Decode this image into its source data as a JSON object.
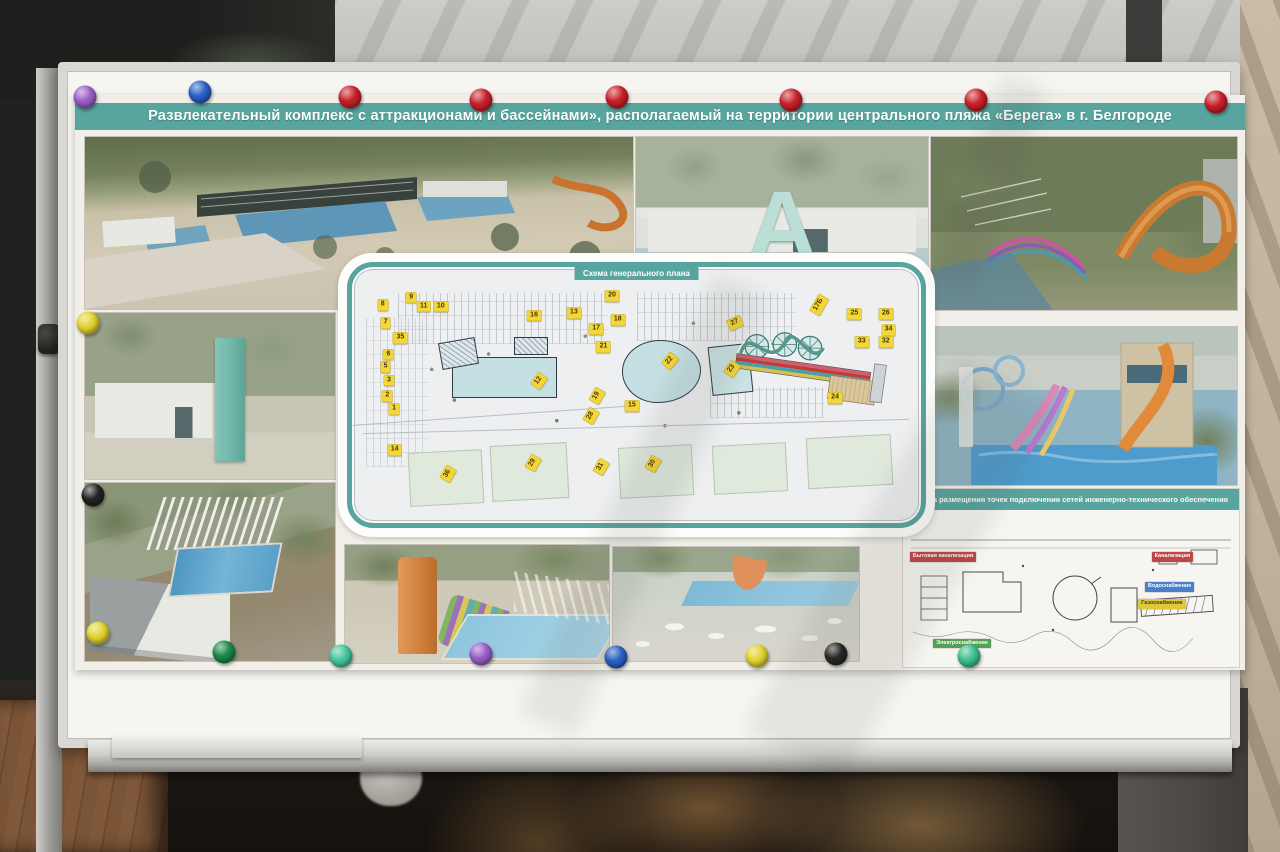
{
  "poster": {
    "title": "Развлекательный комплекс с аттракционами и бассейнами», располагаемый на территории центрального пляжа «Берега» в г. Белгороде",
    "entrance_letter": "A",
    "general_plan": {
      "title": "Схема генерального плана",
      "markers": [
        {
          "n": "8",
          "x": 5.4,
          "y": 14.8
        },
        {
          "n": "9",
          "x": 10.4,
          "y": 12.0
        },
        {
          "n": "11",
          "x": 12.6,
          "y": 15.5
        },
        {
          "n": "10",
          "x": 15.6,
          "y": 15.5
        },
        {
          "n": "7",
          "x": 5.9,
          "y": 21.8
        },
        {
          "n": "35",
          "x": 8.5,
          "y": 27.8
        },
        {
          "n": "6",
          "x": 6.4,
          "y": 34.2
        },
        {
          "n": "5",
          "x": 5.9,
          "y": 39.1
        },
        {
          "n": "3",
          "x": 6.5,
          "y": 44.4
        },
        {
          "n": "2",
          "x": 6.2,
          "y": 50.4
        },
        {
          "n": "1",
          "x": 7.4,
          "y": 55.6
        },
        {
          "n": "14",
          "x": 7.5,
          "y": 71.5
        },
        {
          "n": "16",
          "x": 32.0,
          "y": 19.0
        },
        {
          "n": "13",
          "x": 39.0,
          "y": 18.0
        },
        {
          "n": "17",
          "x": 42.9,
          "y": 24.3
        },
        {
          "n": "18",
          "x": 46.7,
          "y": 20.8
        },
        {
          "n": "20",
          "x": 45.7,
          "y": 11.3
        },
        {
          "n": "21",
          "x": 44.2,
          "y": 31.3
        },
        {
          "n": "12",
          "x": 32.8,
          "y": 44.7,
          "r": -55
        },
        {
          "n": "19",
          "x": 43.0,
          "y": 50.3,
          "r": -60
        },
        {
          "n": "28",
          "x": 42.0,
          "y": 58.1,
          "r": -60
        },
        {
          "n": "15",
          "x": 49.2,
          "y": 54.2
        },
        {
          "n": "22",
          "x": 55.9,
          "y": 36.6,
          "r": -50
        },
        {
          "n": "27",
          "x": 67.3,
          "y": 21.8,
          "r": -25
        },
        {
          "n": "23",
          "x": 66.7,
          "y": 39.8,
          "r": -55
        },
        {
          "n": "24",
          "x": 84.9,
          "y": 51.1
        },
        {
          "n": "25",
          "x": 88.3,
          "y": 18.3
        },
        {
          "n": "26",
          "x": 93.8,
          "y": 18.3
        },
        {
          "n": "34",
          "x": 94.3,
          "y": 24.6
        },
        {
          "n": "33",
          "x": 89.6,
          "y": 29.2
        },
        {
          "n": "32",
          "x": 93.8,
          "y": 29.2
        },
        {
          "n": "17Б",
          "x": 82.1,
          "y": 14.8,
          "r": -60
        },
        {
          "n": "36",
          "x": 16.8,
          "y": 81.0,
          "r": -60
        },
        {
          "n": "29",
          "x": 31.8,
          "y": 76.4,
          "r": -60
        },
        {
          "n": "31",
          "x": 43.7,
          "y": 78.2,
          "r": -60
        },
        {
          "n": "30",
          "x": 52.9,
          "y": 77.1,
          "r": -60
        }
      ]
    },
    "engineering_scheme": {
      "title": "Схема размещения точек подключения сетей инженерно-технического обеспечения",
      "legend": [
        {
          "label": "Бытовая канализация",
          "color": "#c04545",
          "text": "#ffffff",
          "x": 2,
          "y": 27
        },
        {
          "label": "Электроснабжение",
          "color": "#55a055",
          "text": "#ffffff",
          "x": 9,
          "y": 82
        },
        {
          "label": "Канализация",
          "color": "#c04545",
          "text": "#ffffff",
          "x": 74,
          "y": 27
        },
        {
          "label": "Водоснабжение",
          "color": "#4a7ec8",
          "text": "#ffffff",
          "x": 72,
          "y": 46
        },
        {
          "label": "Газоснабжение",
          "color": "#ddc83e",
          "text": "#4a3c00",
          "x": 70,
          "y": 57
        }
      ]
    }
  },
  "magnets": [
    {
      "color": "#9a5fc9",
      "x": 85,
      "y": 97
    },
    {
      "color": "#2a60c8",
      "x": 200,
      "y": 92
    },
    {
      "color": "#c9202a",
      "x": 350,
      "y": 97
    },
    {
      "color": "#c9202a",
      "x": 481,
      "y": 100
    },
    {
      "color": "#c9202a",
      "x": 617,
      "y": 97
    },
    {
      "color": "#c9202a",
      "x": 791,
      "y": 100
    },
    {
      "color": "#c9202a",
      "x": 976,
      "y": 100
    },
    {
      "color": "#c9202a",
      "x": 1216,
      "y": 102
    },
    {
      "color": "#e3d32f",
      "x": 88,
      "y": 323
    },
    {
      "color": "#242424",
      "x": 93,
      "y": 495
    },
    {
      "color": "#e3d32f",
      "x": 98,
      "y": 633
    },
    {
      "color": "#188a4b",
      "x": 224,
      "y": 652
    },
    {
      "color": "#45c79d",
      "x": 341,
      "y": 656
    },
    {
      "color": "#9a5fc9",
      "x": 481,
      "y": 654
    },
    {
      "color": "#2a60c8",
      "x": 616,
      "y": 657
    },
    {
      "color": "#e3d32f",
      "x": 757,
      "y": 656
    },
    {
      "color": "#242424",
      "x": 836,
      "y": 654
    },
    {
      "color": "#3bbf8f",
      "x": 969,
      "y": 656
    }
  ],
  "colors": {
    "accent_teal": "#58a49e",
    "marker_yellow": "#f2d63c"
  }
}
